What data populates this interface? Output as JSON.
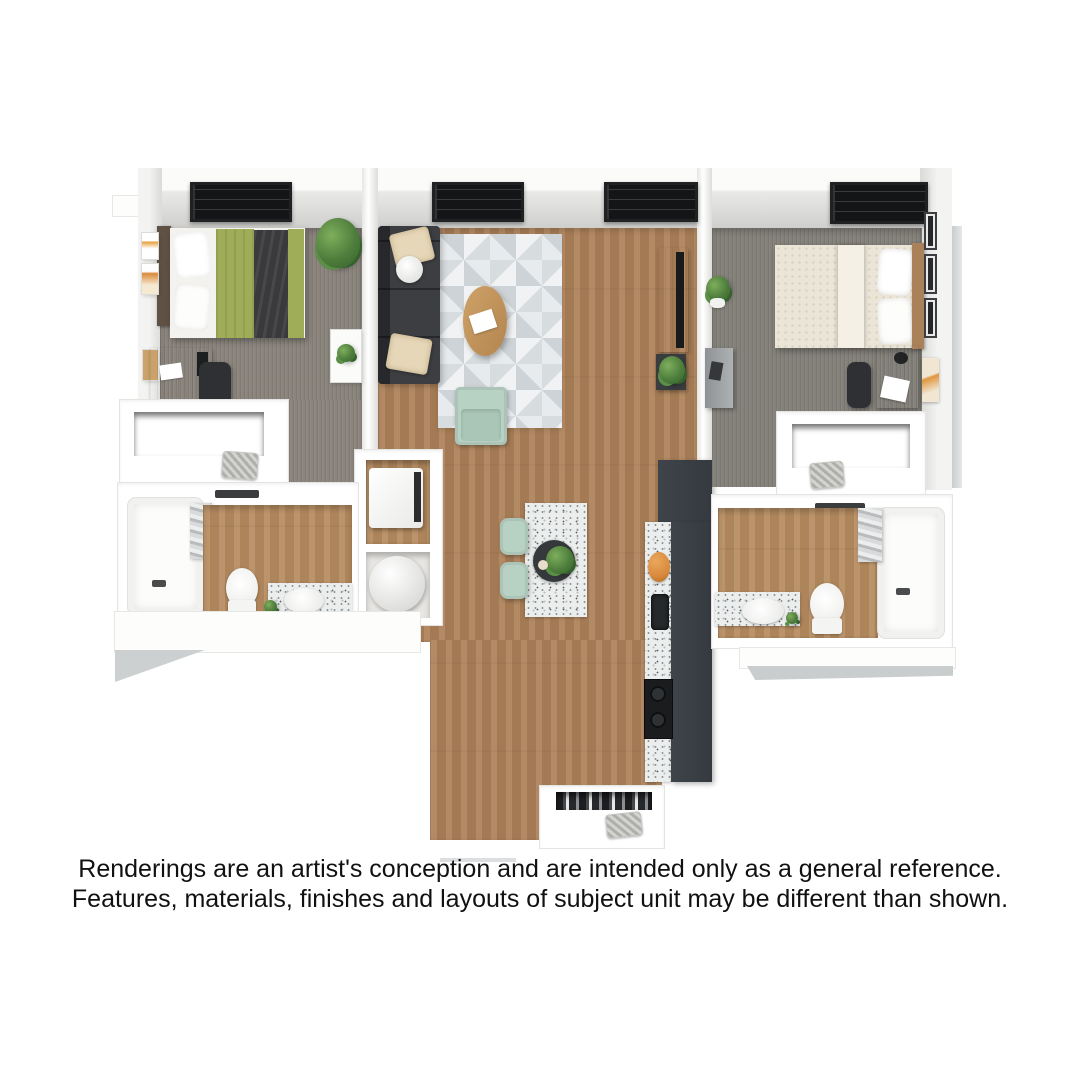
{
  "disclaimer": {
    "line1": "Renderings are an artist's conception and are intended only as a general reference.",
    "line2": "Features, materials, finishes and layouts of subject unit may be different than shown."
  },
  "palette": {
    "wall": "#ffffff",
    "wall_shade": "#d6d6d4",
    "shadow": "#cdd0d1",
    "carpet": "#8a847d",
    "carpet_right": "#84807a",
    "wood": "#ad8158",
    "bath_wood": "#b78c60",
    "rug_light": "#f0f2f3",
    "rug_dark": "#d7dcdf",
    "sofa": "#3c3e42",
    "cushion_cream": "#e6d7b8",
    "blanket_green": "#a0ad58",
    "throw_dark": "#3a3a3c",
    "bedding_white": "#f3f2ef",
    "duvet_cream": "#ebe5d8",
    "mint": "#b7d1c3",
    "kitchen_dark": "#3e444a",
    "appliance_black": "#1b1c1d",
    "counter_base": "#eceeed",
    "counter_fleck": "#8f969a",
    "plant_green": "#4e7e3c",
    "plant_dark": "#35612c",
    "window_dark": "#141516",
    "desk_wood": "#c49a6a",
    "dresser_gray": "#8e9294",
    "orange": "#d98a3c",
    "text": "#111111"
  }
}
